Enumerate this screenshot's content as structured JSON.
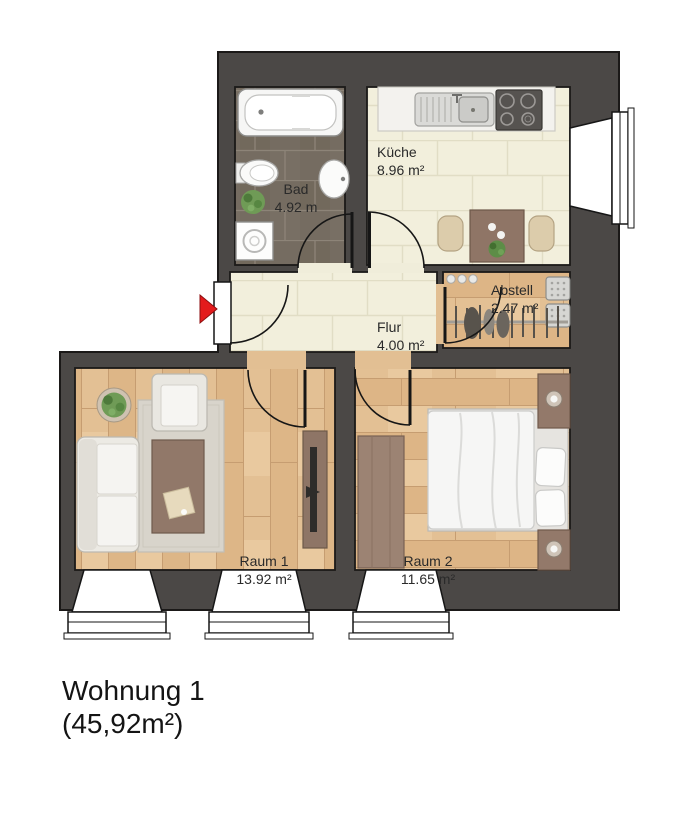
{
  "title": {
    "line1": "Wohnung 1",
    "line2": "(45,92m²)"
  },
  "rooms": [
    {
      "id": "bad",
      "name": "Bad",
      "area": "4.92 m"
    },
    {
      "id": "kueche",
      "name": "Küche",
      "area": "8.96 m²"
    },
    {
      "id": "abstell",
      "name": "Abstell",
      "area": "2.47 m²"
    },
    {
      "id": "flur",
      "name": "Flur",
      "area": "4.00 m²"
    },
    {
      "id": "raum1",
      "name": "Raum 1",
      "area": "13.92 m²"
    },
    {
      "id": "raum2",
      "name": "Raum 2",
      "area": "11.65 m²"
    }
  ],
  "entrance_marker": {
    "shape": "triangle-right",
    "color": "#e31b1c"
  },
  "palette": {
    "wall": "#4b4846",
    "outline": "#1b1918",
    "bath_tile": "#756c61",
    "hall_tile": "#f2efdc",
    "wood": "#e2bf93",
    "rug": "#d8d4cb",
    "furniture_brown": "#8f7566",
    "white_fixture": "#f7f7f6"
  }
}
